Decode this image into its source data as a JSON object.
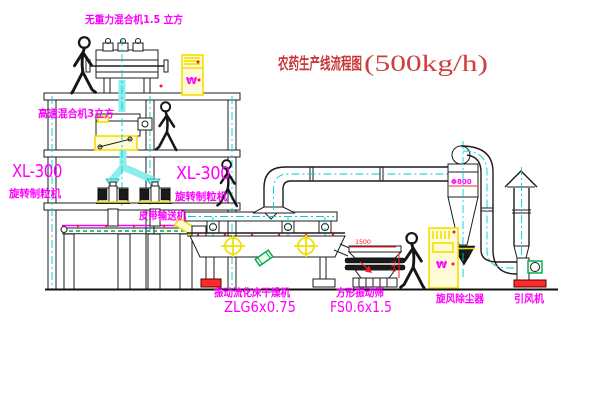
{
  "title": {
    "text": "农药生产线流程图",
    "capacity": "(500kg/h)"
  },
  "labels": {
    "weightless_mixer": "无重力混合机1.5 立方",
    "high_speed_mixer": "高速混合机3立方",
    "granulator_left": {
      "model": "XL-300",
      "name": "旋转制粒机"
    },
    "granulator_right": {
      "model": "XL-300",
      "name": "旋转制粒机"
    },
    "belt_conveyor": "皮带输送机",
    "fluid_bed_dryer": {
      "name": "振动流化床干燥机",
      "model": "ZLG6x0.75"
    },
    "square_sieve": {
      "name": "方形振动筛",
      "model": "FS0.6x1.5"
    },
    "cyclone": {
      "name": "旋风除尘器",
      "dia": "Φ800"
    },
    "fan": "引风机"
  },
  "dimensions": {
    "sieve_length": "1500",
    "sieve_height": "541"
  },
  "cabinet_symbol": "₩",
  "colors": {
    "line": "#1c1c1c",
    "centerline_cyan": "#00cfcf",
    "label_magenta": "#ff00ff",
    "accent_red": "#ff2222",
    "equipment_yellow": "#f2e000",
    "motor_green": "#00a550",
    "title_red": "#c83434"
  }
}
